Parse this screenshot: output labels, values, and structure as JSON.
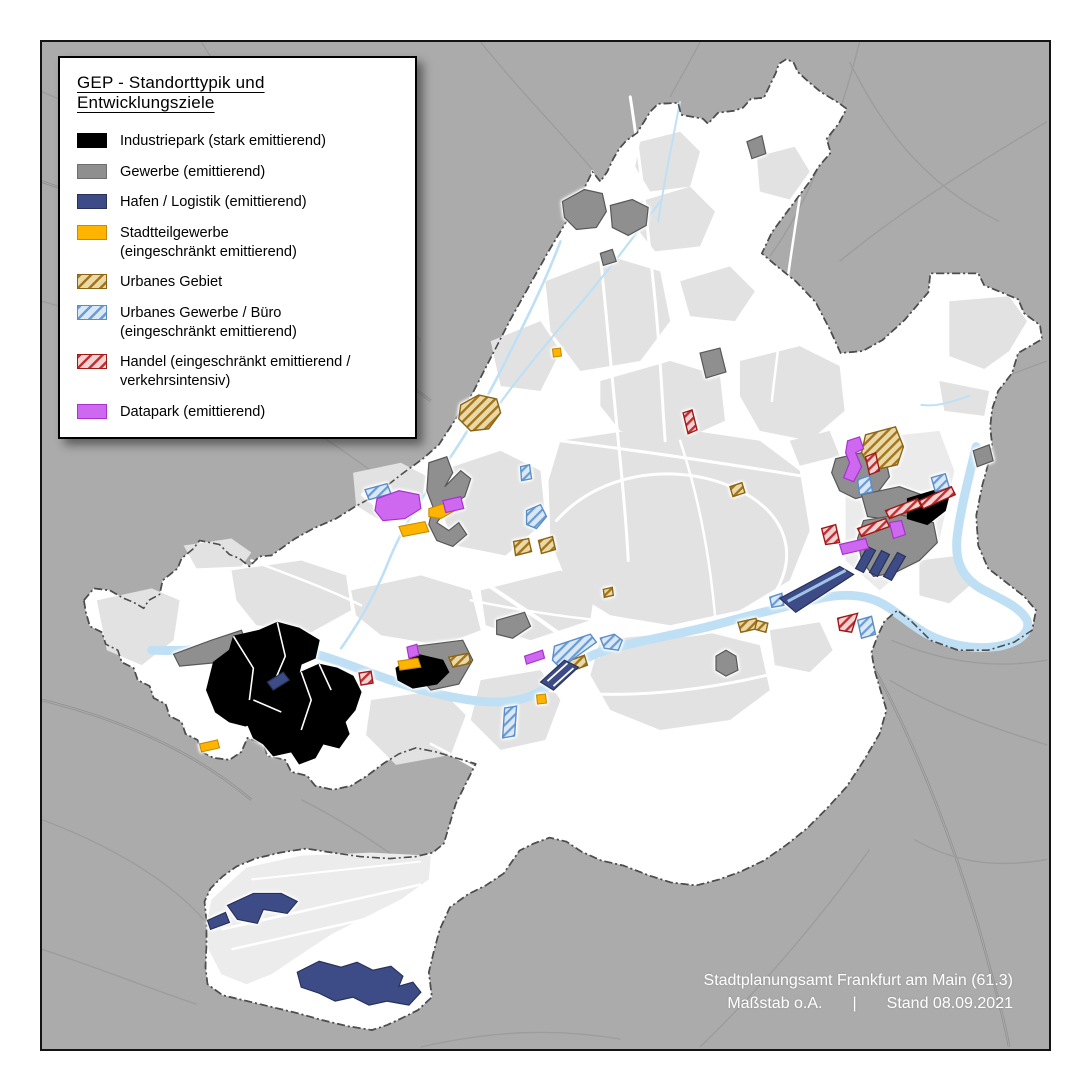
{
  "legend": {
    "title": "GEP - Standorttypik und Entwicklungsziele",
    "items": [
      {
        "id": "industriepark",
        "label": "Industriepark (stark emittierend)",
        "label2": "",
        "swatch": "solid",
        "color": "#000000",
        "border_color": "#000000"
      },
      {
        "id": "gewerbe",
        "label": "Gewerbe (emittierend)",
        "label2": "",
        "swatch": "solid",
        "color": "#8f8f8f",
        "border_color": "#6e6e6e"
      },
      {
        "id": "hafen-logistik",
        "label": "Hafen / Logistik (emittierend)",
        "label2": "",
        "swatch": "solid",
        "color": "#3d4c87",
        "border_color": "#283259"
      },
      {
        "id": "stadtteilgewerbe",
        "label": "Stadtteilgewerbe",
        "label2": "(eingeschränkt emittierend)",
        "swatch": "solid",
        "color": "#ffb400",
        "border_color": "#c78c00"
      },
      {
        "id": "urbanes-gebiet",
        "label": "Urbanes Gebiet",
        "label2": "",
        "swatch": "hatch",
        "color": "#ead8a6",
        "stripe_color": "#a2761c",
        "border_color": "#8a6414"
      },
      {
        "id": "urbanes-gewerbe-buero",
        "label": "Urbanes Gewerbe / Büro",
        "label2": "(eingeschränkt emittierend)",
        "swatch": "hatch",
        "color": "#d8e8f6",
        "stripe_color": "#6b9bd2",
        "border_color": "#5b8ec6"
      },
      {
        "id": "handel",
        "label": "Handel (eingeschränkt emittierend /",
        "label2": "verkehrsintensiv)",
        "swatch": "hatch",
        "color": "#f2d2d2",
        "stripe_color": "#c03030",
        "border_color": "#a01818"
      },
      {
        "id": "datapark",
        "label": "Datapark (emittierend)",
        "label2": "",
        "swatch": "solid",
        "color": "#cf68f0",
        "border_color": "#a733cc"
      }
    ]
  },
  "credits": {
    "line1": "Stadtplanungsamt Frankfurt am Main (61.3)",
    "scale_label": "Maßstab o.A.",
    "separator": "|",
    "date_label": "Stand 08.09.2021"
  },
  "map": {
    "colors": {
      "outside": "#ababab",
      "city_area": "#ffffff",
      "urban_blocks": "#e2e2e2",
      "water": "#bfe0f4",
      "boundary": "#4d4d4d"
    }
  }
}
